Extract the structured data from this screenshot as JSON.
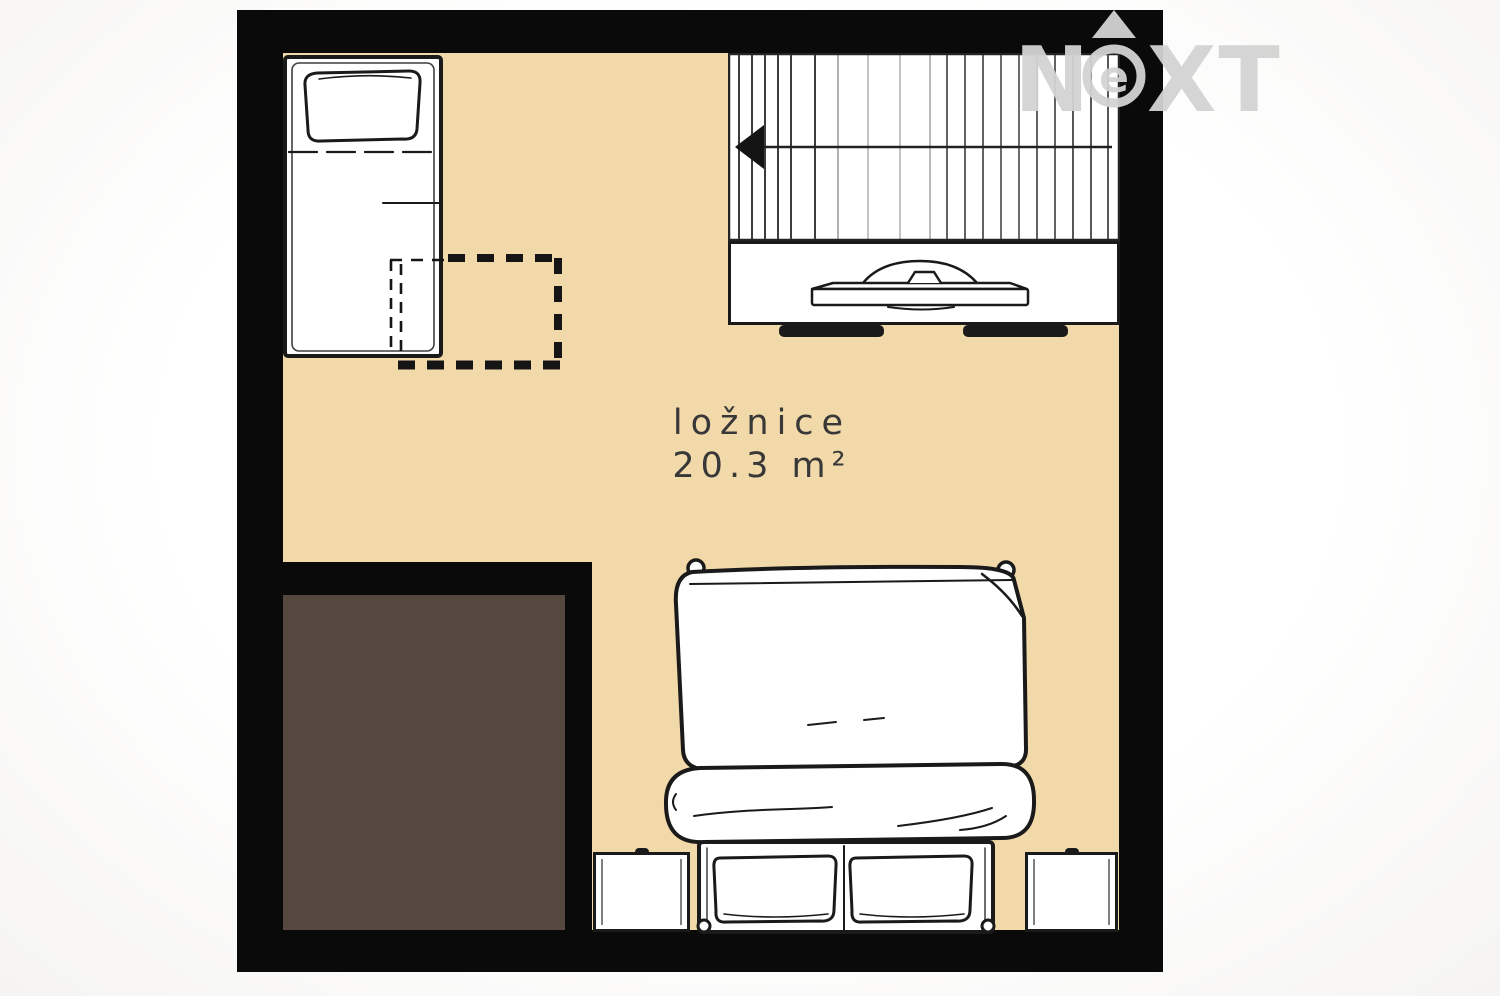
{
  "room": {
    "name": "ložnice",
    "area": "20.3 m²"
  },
  "watermark": {
    "brand": "NEXT",
    "left": "N",
    "circle_letter": "e",
    "right": "XT"
  },
  "colors": {
    "wall": "#0a0a0a",
    "floor": "#f2d9a9",
    "void": "#564840",
    "furniture_fill": "#ffffff",
    "line": "#1a1a1a",
    "label_text": "#383838",
    "watermark": "#d3d3d3"
  }
}
